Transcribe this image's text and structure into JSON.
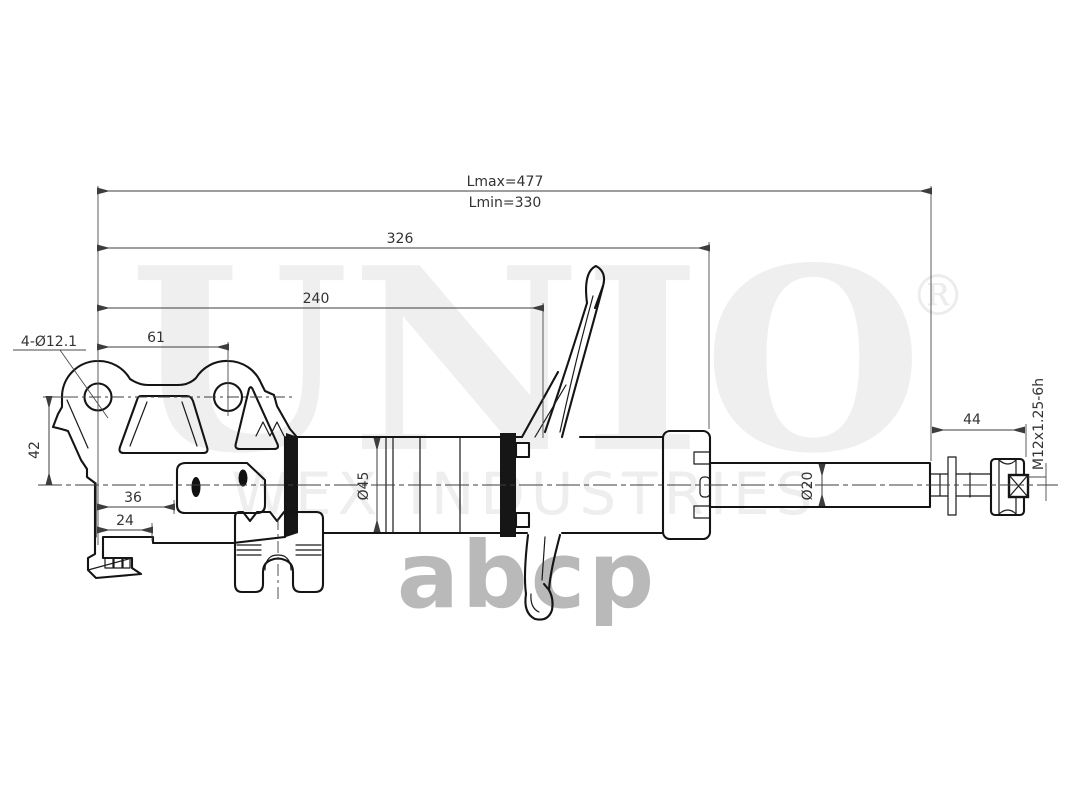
{
  "watermarks": {
    "brand": "UNIO",
    "registered": "®",
    "industries": "WEX INDUSTRIES",
    "logo": "abcp"
  },
  "dims": {
    "lmax": "Lmax=477",
    "lmin": "Lmin=330",
    "len_326": "326",
    "len_240": "240",
    "len_61": "61",
    "holes": "4-Ø12.1",
    "len_42": "42",
    "len_36": "36",
    "len_24": "24",
    "dia_tube": "Ø45",
    "dia_rod": "Ø20",
    "len_44": "44",
    "thread": "M12x1.25-6h"
  },
  "colors": {
    "line": "#141414",
    "dimension": "#3d3d3d",
    "watermark_light": "#efefef",
    "watermark_logo": "#b9b9b9"
  }
}
